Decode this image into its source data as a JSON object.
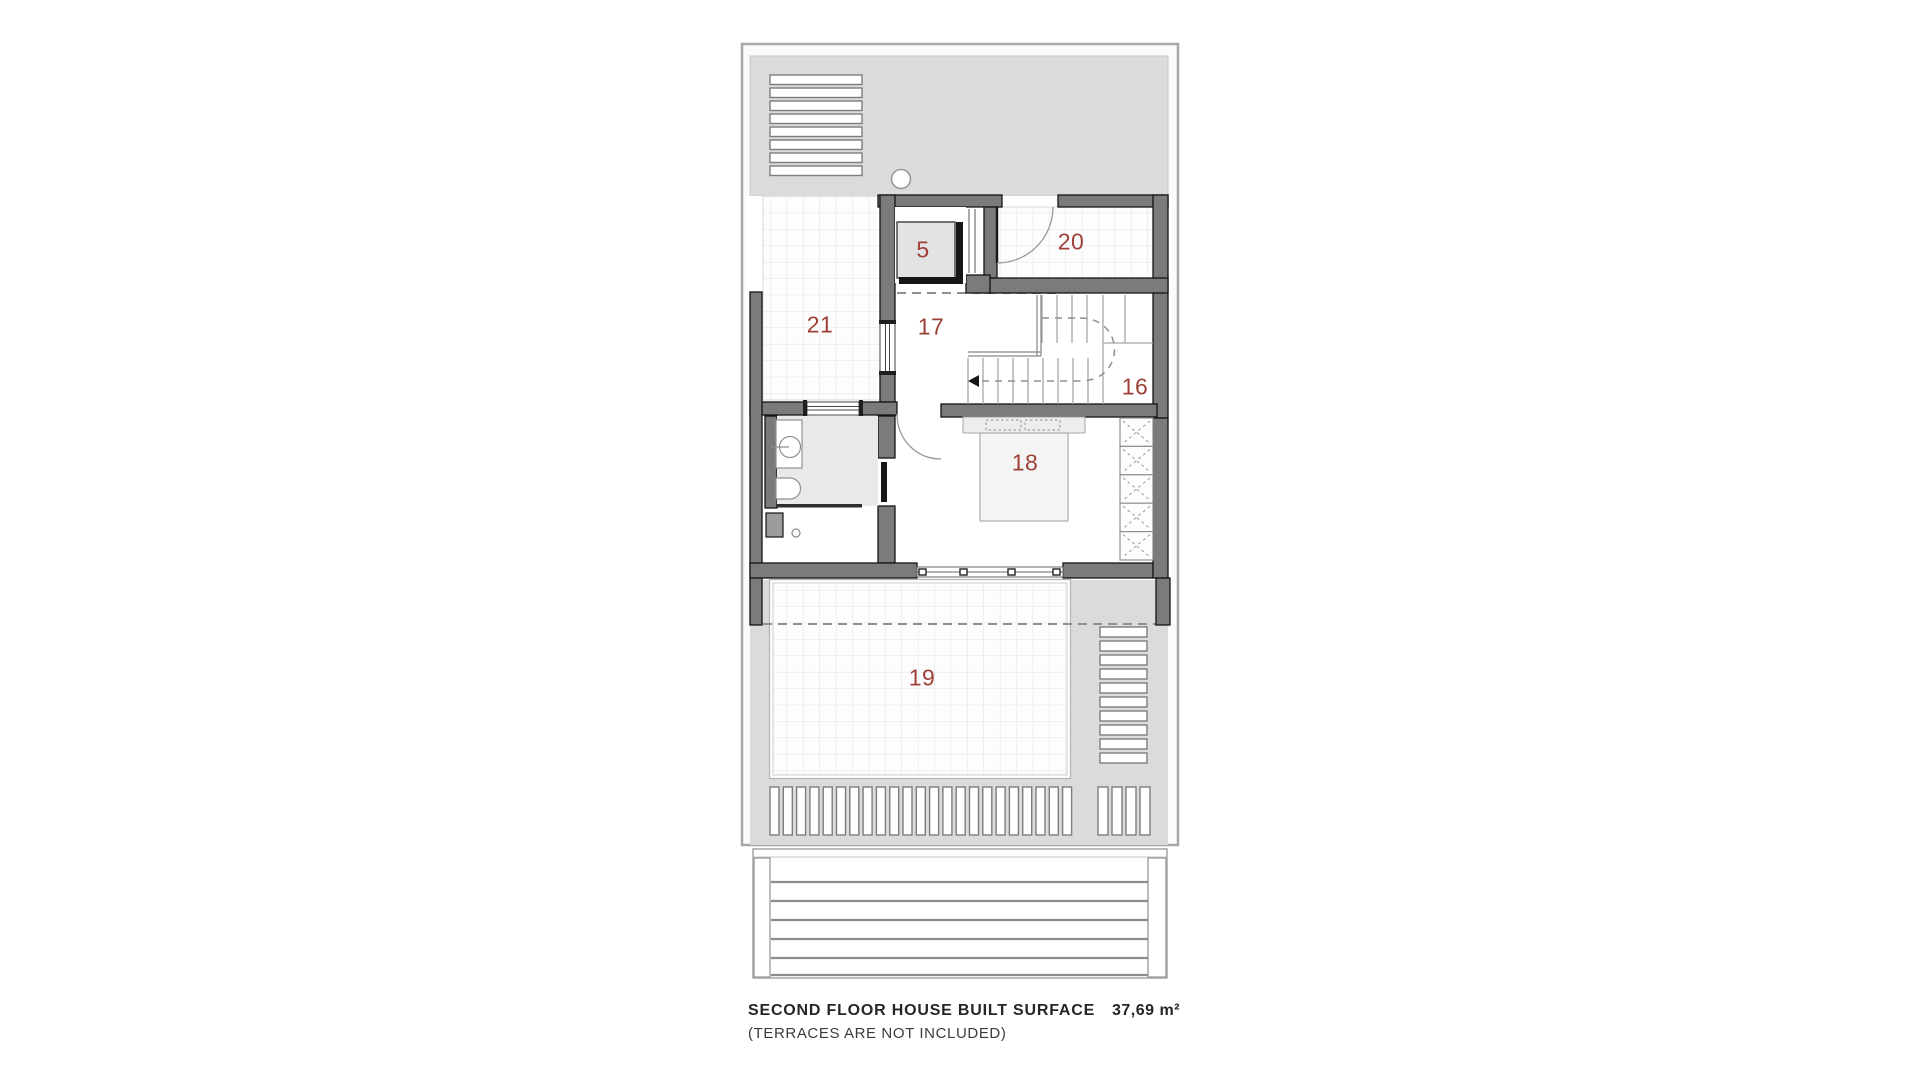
{
  "rooms": {
    "r5": {
      "label": "5"
    },
    "r16": {
      "label": "16"
    },
    "r17": {
      "label": "17"
    },
    "r18": {
      "label": "18"
    },
    "r19": {
      "label": "19"
    },
    "r20": {
      "label": "20"
    },
    "r21": {
      "label": "21"
    }
  },
  "caption": {
    "title": "SECOND FLOOR HOUSE BUILT SURFACE",
    "note": "(TERRACES ARE NOT INCLUDED)",
    "area": "37,69 m²"
  },
  "colors": {
    "wall_fill": "#7b7b7b",
    "wall_outline": "#151515",
    "terrace_fill": "#dbdbdb",
    "room_label_accent": "#9e4038"
  }
}
